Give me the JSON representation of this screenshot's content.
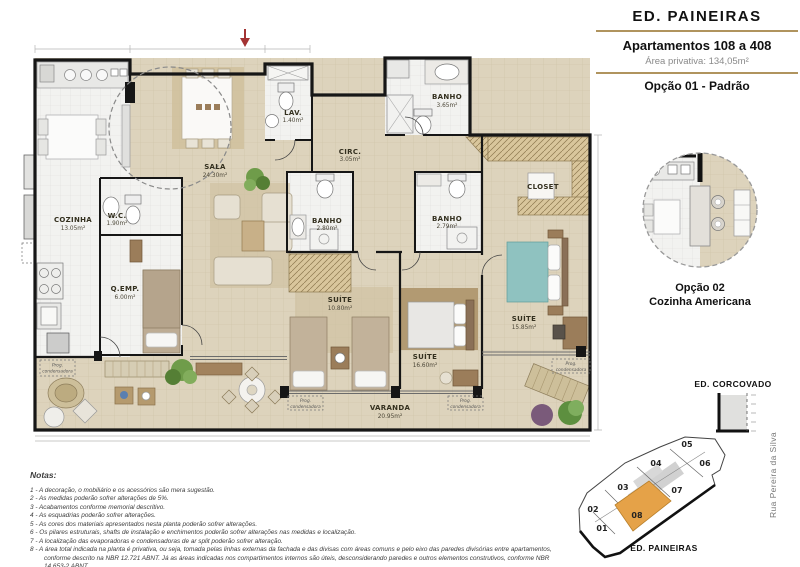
{
  "header": {
    "building": "ED. PAINEIRAS",
    "apartments": "Apartamentos 108 a 408",
    "area_label": "Área privativa:",
    "area_value": "134,05m²",
    "option1": "Opção 01 - Padrão"
  },
  "detail_option2": {
    "line1": "Opção 02",
    "line2": "Cozinha Americana"
  },
  "corcovado_label": "ED. CORCOVADO",
  "site_plan": {
    "units": [
      "01",
      "02",
      "03",
      "04",
      "05",
      "06",
      "07",
      "08"
    ],
    "highlighted_unit": "08",
    "highlight_color": "#E5A248",
    "building_label": "ED. PAINEIRAS",
    "street_label": "Rua Pereira da Silva"
  },
  "plan": {
    "rooms": {
      "cozinha": {
        "name": "COZINHA",
        "area": "13.05m²"
      },
      "wc": {
        "name": "W.C.",
        "area": "1.90m²"
      },
      "qemp": {
        "name": "Q.EMP.",
        "area": "6.00m²"
      },
      "sala": {
        "name": "SALA",
        "area": "24.30m²"
      },
      "lav": {
        "name": "LAV.",
        "area": "1.40m²"
      },
      "circ": {
        "name": "CIRC.",
        "area": "3.05m²"
      },
      "banho_social": {
        "name": "BANHO",
        "area": "3.65m²"
      },
      "banho_suite1": {
        "name": "BANHO",
        "area": "2.80m²"
      },
      "banho_suite2": {
        "name": "BANHO",
        "area": "2.79m²"
      },
      "closet": {
        "name": "CLOSET",
        "area": ""
      },
      "suite1": {
        "name": "SUÍTE",
        "area": "10.80m²"
      },
      "suite2": {
        "name": "SUÍTE",
        "area": "16.60m²"
      },
      "suite3": {
        "name": "SUÍTE",
        "area": "15.85m²"
      },
      "varanda": {
        "name": "VARANDA",
        "area": "20.95m²"
      }
    },
    "condenser_line1": "Prog.",
    "condenser_line2": "condensadora"
  },
  "notes": {
    "title": "Notas:",
    "items": [
      "1 - A decoração, o mobiliário e os acessórios são mera sugestão.",
      "2 - As medidas poderão sofrer alterações de 5%.",
      "3 - Acabamentos conforme memorial descritivo.",
      "4 - As esquadrias poderão sofrer alterações.",
      "5 - As cores dos materiais apresentados nesta planta poderão sofrer alterações.",
      "6 - Os pilares estruturais, shafts de instalação e enchimentos poderão sofrer alterações nas medidas e localização.",
      "7 - A localização das evaporadoras e condensadoras de ar split poderão sofrer alteração.",
      "8 - A área total indicada na planta é privativa, ou seja, tomada pelas linhas externas da fachada e das divisas com áreas comuns e pelo eixo das paredes divisórias entre apartamentos, conforme descrito na NBR 12.721 ABNT. Já as áreas indicadas nos compartimentos internos são úteis, desconsiderando paredes e outros elementos construtivos, conforme NBR 14.653-2 ABNT."
    ]
  }
}
